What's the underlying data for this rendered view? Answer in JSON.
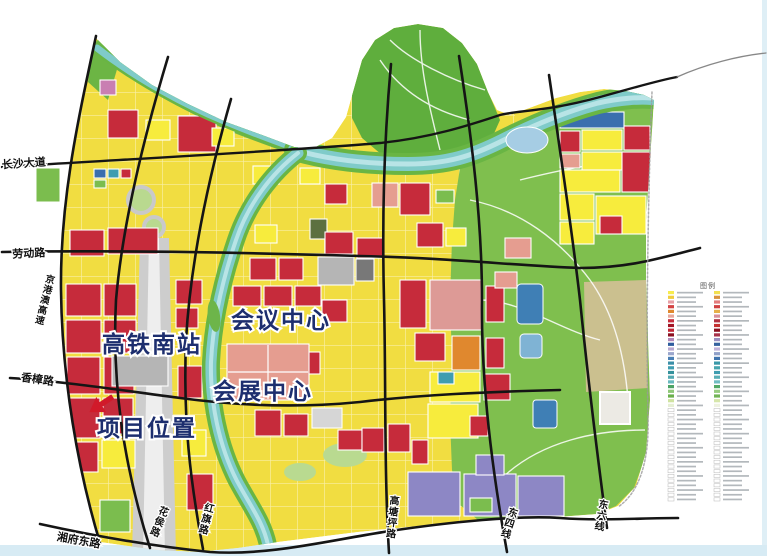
{
  "map": {
    "poi_labels": {
      "station": "高铁南站",
      "conference_center": "会议中心",
      "exhibition_center": "会展中心",
      "project_location": "项目位置"
    },
    "road_labels": {
      "changsha_avenue": "长沙大道",
      "laodong_road": "劳动路",
      "jinggangao_expressway": "京港澳高速",
      "xiangzhang_road": "香樟路",
      "xiangfu_east_road": "湘府东路",
      "huahou_road": "花侯路",
      "hongqi_road": "红旗路",
      "gaotangping_road": "高塘坪路",
      "dongsi_line": "东四线",
      "dongliu_line": "东六线"
    },
    "marker_color": "#d11a2a",
    "zone_colors": {
      "residential_yellow": "#f1dd41",
      "commercial_red": "#c62b3b",
      "exhibition_salmon": "#e59d90",
      "rose_pink": "#dd9a96",
      "park_green": "#7bbd4e",
      "hill_green": "#5fae3d",
      "river_teal": "#7fcbc9",
      "river_bank_green": "#69b544",
      "purple_zone": "#8d87c5",
      "blue_zone": "#3a6fae",
      "teal_zone": "#3f9db0",
      "orange_zone": "#e0882e",
      "station_gray": "#cdcdcd",
      "khaki_area": "#cbc08f",
      "magenta_pink": "#c97fb2",
      "road_black": "#151515",
      "label_navy": "#1d2e6e"
    }
  },
  "legend": {
    "title": "图例",
    "left_colors": [
      "#f7ec4e",
      "#f0cd3d",
      "#e8a0a6",
      "#d34343",
      "#e0892e",
      "#e8a79a",
      "#c62b3b",
      "#a31525",
      "#c22535",
      "#8c1020",
      "#b086b8",
      "#2f5d9e",
      "#b8a8d0",
      "#9aa6cc",
      "#4a7fb5",
      "#3a8fa8",
      "#3f9db0",
      "#35919c",
      "#52a8b0",
      "#68b8bf",
      "#4ca365",
      "#8fc878",
      "#6ab04c",
      "#cfe3a0",
      "#e6efd4",
      "#ffffff",
      "#ffffff",
      "#ffffff",
      "#ffffff",
      "#ffffff",
      "#ffffff",
      "#ffffff",
      "#ffffff",
      "#ffffff",
      "#ffffff",
      "#ffffff",
      "#ffffff",
      "#ffffff",
      "#ffffff",
      "#ffffff",
      "#ffffff",
      "#ffffff",
      "#ffffff",
      "#ffffff",
      "#ffffff"
    ],
    "right_colors": [
      "#f2e050",
      "#d9913e",
      "#e37c7c",
      "#cf4040",
      "#e6b04a",
      "#d88f9a",
      "#b03040",
      "#c43030",
      "#8c1020",
      "#a8324a",
      "#9a8fc0",
      "#35629e",
      "#c0b2d8",
      "#8fa0c8",
      "#3f74ae",
      "#3a98a8",
      "#46a4ad",
      "#3f9db0",
      "#58aeb5",
      "#70bcc2",
      "#52a865",
      "#98cc80",
      "#72b455",
      "#d6e6aa",
      "#eef2e0",
      "#ffffff",
      "#ffffff",
      "#ffffff",
      "#ffffff",
      "#ffffff",
      "#ffffff",
      "#ffffff",
      "#ffffff",
      "#ffffff",
      "#ffffff",
      "#ffffff",
      "#ffffff",
      "#ffffff",
      "#ffffff",
      "#ffffff",
      "#ffffff",
      "#ffffff",
      "#ffffff",
      "#ffffff",
      "#ffffff"
    ]
  }
}
